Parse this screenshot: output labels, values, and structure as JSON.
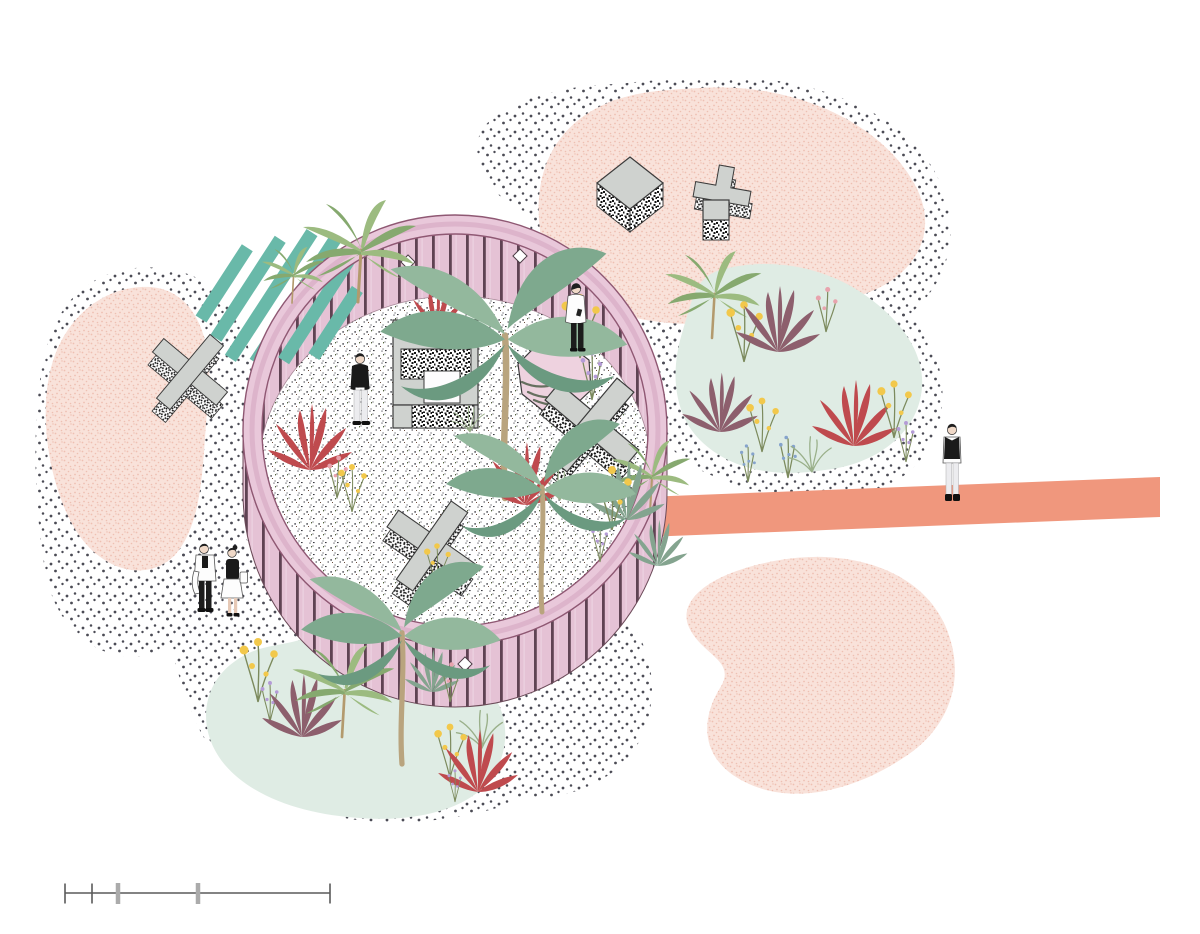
{
  "document": {
    "title": "Circular garden pavilion - axonometric landscape collage illustration",
    "type": "architectural illustration plan"
  },
  "colors": {
    "background": "#ffffff",
    "pavilion_rim": "#e9c8da",
    "rim_line": "#8f5873",
    "slat_pink": "#e5c2d5",
    "slat_line": "#5f4353",
    "stripe_teal": "#69b9a9",
    "walkway_coral": "#f0977d",
    "blob_pink": "#f9e2da",
    "blob_speck": "#eec0b2",
    "bed_mint": "#dfece4",
    "dot_gray": "#4b4b55",
    "object_gray": "#cfd2cf",
    "object_outline": "#3b3b3b",
    "octagon_pink": "#eed2df"
  },
  "scene": {
    "background": "white",
    "pavilion": {
      "name": "circular slatted pavilion",
      "wall_style": "pink vertical slats with diamond studs",
      "floor_texture": "fine speckled terrazzo dots"
    },
    "ground_textures": [
      {
        "name": "polka-dot field left"
      },
      {
        "name": "polka-dot field bottom"
      },
      {
        "name": "polka-dot field around right flower bed"
      },
      {
        "name": "polka-dot field around top-right blob"
      }
    ],
    "blobs": [
      {
        "name": "pink blob left"
      },
      {
        "name": "pink blob top-right"
      },
      {
        "name": "pink blob bottom-right"
      }
    ],
    "flower_beds": [
      {
        "name": "mint flower bed right"
      },
      {
        "name": "mint flower bed bottom-left"
      }
    ],
    "stripes": {
      "name": "teal diagonal stripes",
      "count": 6
    },
    "walkway": {
      "name": "coral walkway",
      "direction": "extends east from pavilion"
    },
    "sculptures": [
      {
        "name": "hollow square frame",
        "finish": "gray top, static-noise sides"
      },
      {
        "name": "pink octagon slab with leaf shadows"
      },
      {
        "name": "x-cross sculpture beside octagon"
      },
      {
        "name": "x-cross sculpture lower interior"
      },
      {
        "name": "x-cross sculpture outside left"
      },
      {
        "name": "plus-cross sculpture top-right"
      },
      {
        "name": "cube sculpture top-right"
      },
      {
        "name": "small cube plinth top-right"
      }
    ],
    "people": [
      {
        "name": "man in black sweater and light trousers"
      },
      {
        "name": "man in white shirt using phone"
      },
      {
        "name": "couple walking with coat and handbag"
      },
      {
        "name": "woman in black vest walking on coral walkway"
      }
    ],
    "plants": {
      "types": [
        "banana tree",
        "fan palm",
        "red cordyline",
        "purple cordyline",
        "green cordyline",
        "yellow wildflowers",
        "purple wildflowers",
        "blue wildflowers",
        "pink wildflowers",
        "grass tuft"
      ]
    }
  },
  "scale_bar": {
    "x_start_px": 65,
    "x_end_px": 330,
    "y_px": 893,
    "minor_ticks_px": [
      65,
      92,
      330
    ],
    "major_ticks_px": [
      118,
      198
    ],
    "labels": []
  }
}
